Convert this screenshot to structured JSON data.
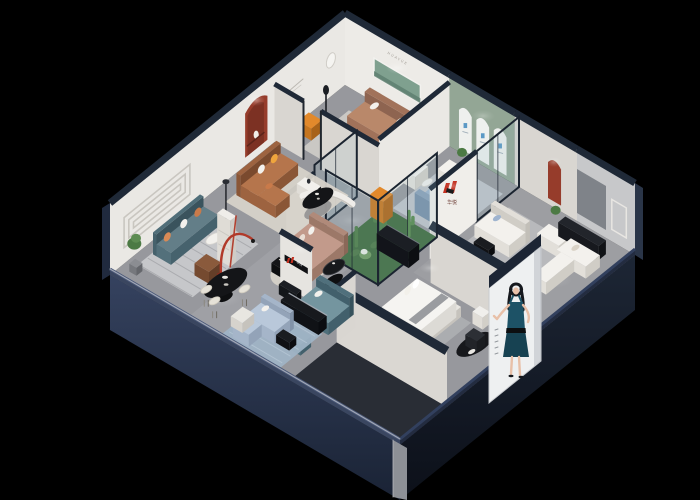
{
  "canvas": {
    "width": 700,
    "height": 500,
    "background": "#000000"
  },
  "texts": {
    "back_wall_sign": "HUAYUE",
    "brand_wall_logo": "华悦",
    "shelf_brand_logo": "华悦"
  },
  "colors": {
    "floor": "#97989d",
    "floor_light": "#aeafb4",
    "floor_dark": "#6f7176",
    "wall": "#eae8e4",
    "wall_bright": "#edebe7",
    "wall_shade": "#d9d6d1",
    "wall_gray": "#c7c8ca",
    "cap": "#1f2937",
    "cap_light": "#2e3b55",
    "rim_left": "#25304a",
    "rim_right": "#10151f",
    "column_gray": "#8d9096",
    "sage_green": "#93a695",
    "arch_white": "#eef0ee",
    "arch_logo_blue": "#4a8fc0",
    "niche_red": "#963c2b",
    "caramel_sofa": "#b5754c",
    "caramel_dark": "#8e5636",
    "yellow_pillow": "#efa53d",
    "white_fabric": "#f3f1ed",
    "teal_sofa": "#64858f",
    "left_sofa_blue": "#637e88",
    "light_blue_sofa": "#b9c8da",
    "pink_sofa": "#c29a8b",
    "blue_sofa": "#9db3cb",
    "green_bench": "#9eb4a6",
    "cactus_green": "#4d7d44",
    "atrium_green": "#3f6b3c",
    "black_gloss": "#141518",
    "cream": "#d9d5cd",
    "orange_cabinet": "#e2892b",
    "orange_pillow": "#c97a4a",
    "brand_red": "#c23020",
    "lamp_red": "#b13a2a",
    "poster_bg": "#eef0f1",
    "dress_teal": "#1d5266",
    "skin": "#e8c0a8",
    "hair": "#15181d"
  },
  "scene_elements": [
    "isometric-showroom-cutaway",
    "top-lounge-room",
    "arch-display-room",
    "white-sofa-room",
    "corner-sectional-room",
    "caramel-sofa-room",
    "center-display-area",
    "cactus-atrium",
    "bedroom-display",
    "teal-sofa-area",
    "left-lounge-room",
    "dining-display",
    "front-lounge-room",
    "brand-poster-model",
    "red-arch-niche",
    "green-wall-arches",
    "brand-logo-wall",
    "brand-shelf"
  ]
}
